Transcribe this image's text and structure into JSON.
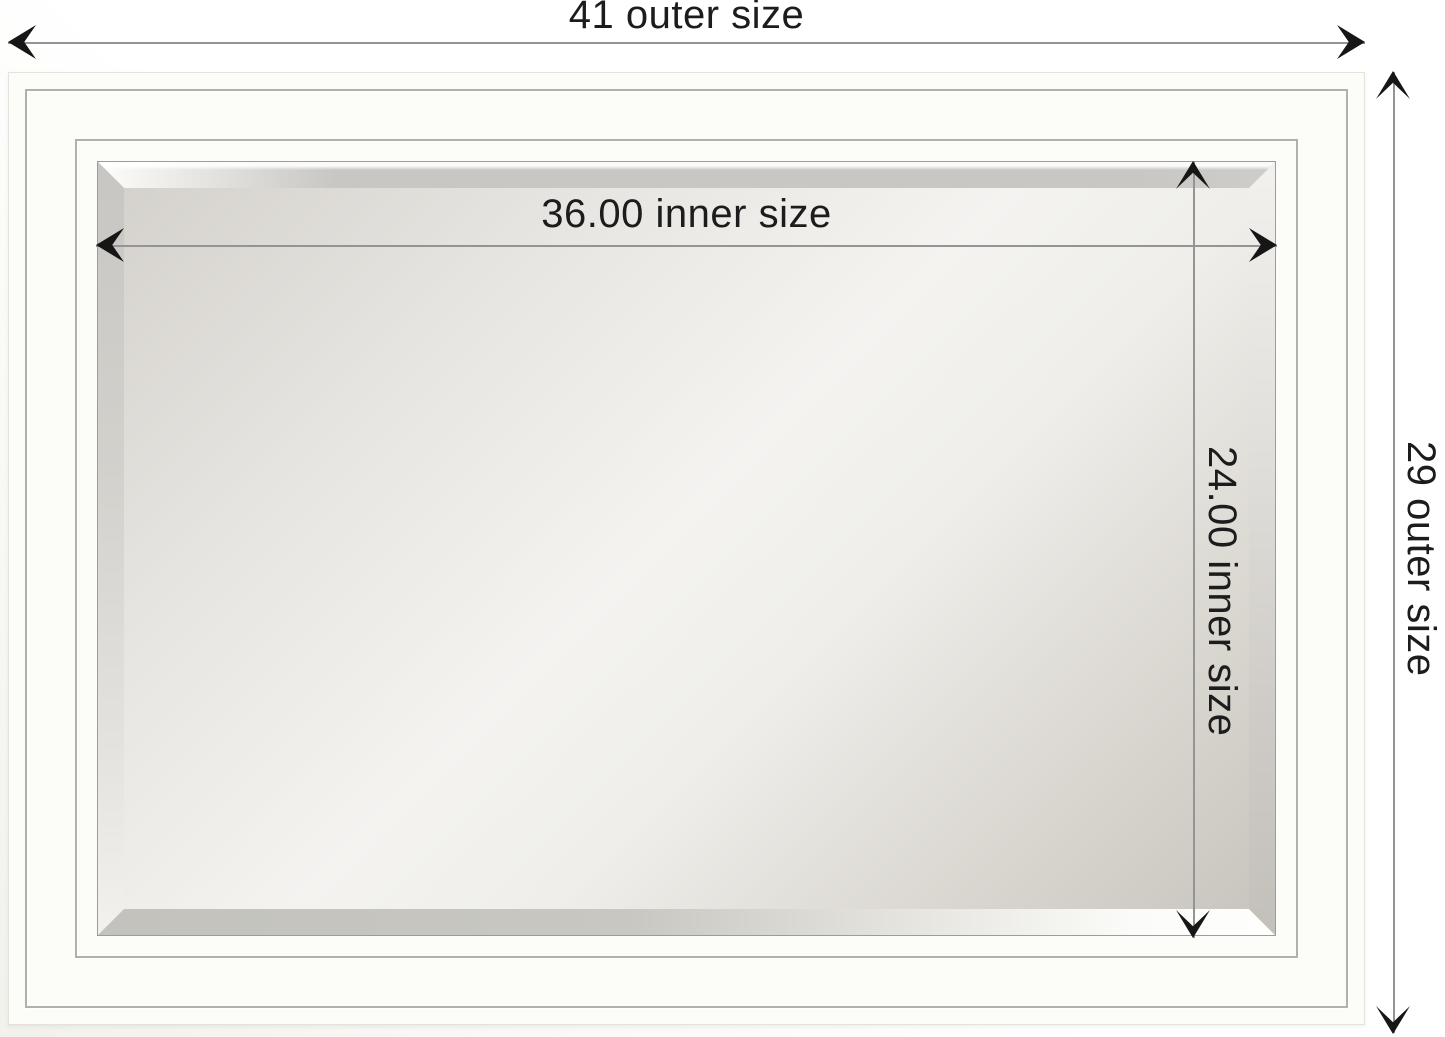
{
  "diagram": {
    "type": "product-dimension-diagram",
    "subject": "beveled wall mirror in white frame",
    "dims": {
      "outer_width": {
        "label": "41 outer size",
        "value": 41
      },
      "outer_height": {
        "label": "29 outer size",
        "value": 29
      },
      "inner_width": {
        "label": "36.00 inner size",
        "value": 36.0
      },
      "inner_height": {
        "label": "24.00 inner size",
        "value": 24.0
      }
    },
    "colors": {
      "background": "#ffffff",
      "frame_white": "#fcfcf9",
      "groove_gray": "#aeb2aa",
      "bevel_gray": "#c9c7c3",
      "glass_highlight": "#f4f3f0",
      "glass_shadow": "#c9c6bf",
      "dimension_line": "#949494",
      "arrowhead": "#161616",
      "label_text": "#1c1c1c"
    }
  }
}
